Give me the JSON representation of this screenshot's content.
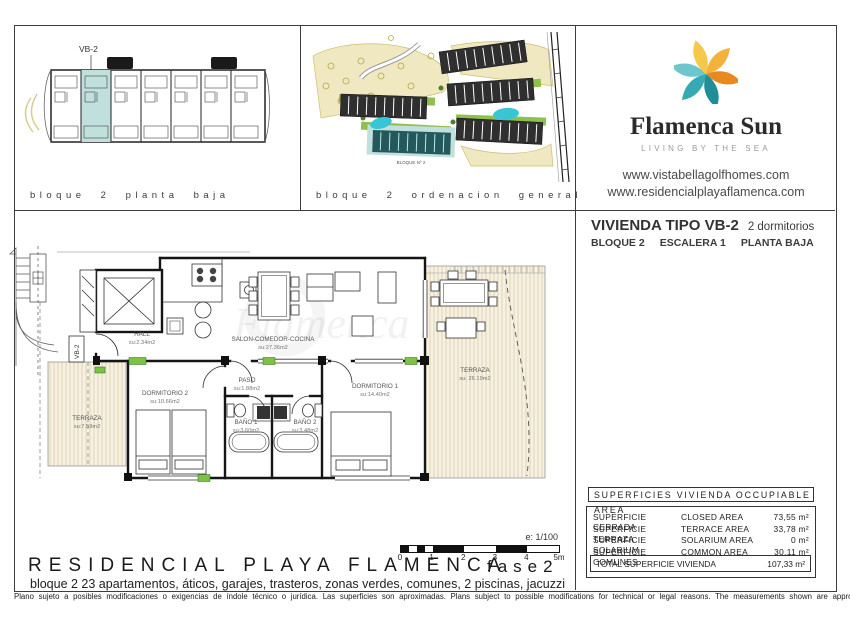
{
  "panels": {
    "block_plan": {
      "caption": "bloque 2 planta baja",
      "unit_label": "VB-2",
      "highlight_color": "#bfe0dd"
    },
    "site_plan": {
      "caption": "bloque 2 ordenacion general",
      "block_label": "BLOQUE Nº 2",
      "pool_color": "#38c6d6"
    }
  },
  "brand": {
    "name": "Flamenca Sun",
    "tagline": "LIVING BY THE SEA",
    "websites": [
      "www.vistabellagolfhomes.com",
      "www.residencialplayaflamenca.com"
    ],
    "logo_colors": [
      "#f3b23c",
      "#e8891f",
      "#1f8e96",
      "#35aab2",
      "#6cc6cb",
      "#f5c84c"
    ]
  },
  "unit_header": {
    "title": "VIVIENDA TIPO VB-2",
    "subtitle": "2 dormitorios",
    "line2": [
      "BLOQUE 2",
      "ESCALERA 1",
      "PLANTA BAJA"
    ]
  },
  "floor_plan": {
    "unit_tag": "VB-2",
    "watermark": "Flamenca Sun",
    "marker_color": "#7dc242",
    "terrace_fill": "#f6f1e2",
    "rooms": {
      "hall": {
        "name": "HALL",
        "area": "su:2.34m2"
      },
      "salon": {
        "name": "SALON-COMEDOR-COCINA",
        "area": "su:27.36m2"
      },
      "paso": {
        "name": "PASO",
        "area": "su:1.88m2"
      },
      "dormitorio1": {
        "name": "DORMITORIO 1",
        "area": "su:14.40m2"
      },
      "dormitorio2": {
        "name": "DORMITORIO 2",
        "area": "su:10.66m2"
      },
      "bano1": {
        "name": "BAÑO 1",
        "area": "su:3.60m2"
      },
      "bano2": {
        "name": "BAÑO 2",
        "area": "su:3.48m2"
      },
      "terraza_izq": {
        "name": "TERRAZA",
        "area": "su:7.59m2"
      },
      "terraza_der": {
        "name": "TERRAZA",
        "area": "su: 26.19m2"
      }
    },
    "scale": {
      "note": "e: 1/100",
      "ticks": [
        "0",
        "1",
        "2",
        "3",
        "4",
        "5m"
      ]
    }
  },
  "areas_table": {
    "header": "SUPERFICIES  VIVIENDA  OCCUPIABLE  AREA",
    "rows": [
      {
        "es": "SUPERFICIE CERRADA",
        "en": "CLOSED AREA",
        "value": "73,55 m²"
      },
      {
        "es": "SUPERFICIE TERRAZA",
        "en": "TERRACE AREA",
        "value": "33,78 m²"
      },
      {
        "es": "SUPERFICIE SOLARIUM",
        "en": "SOLARIUM AREA",
        "value": "0 m²"
      },
      {
        "es": "SUPERFICIE COMUNES",
        "en": "COMMON AREA",
        "value": "30,11 m²"
      }
    ],
    "total_label": "TOTAL SUPERFICIE VIVIENDA",
    "total_value": "107,33 m²"
  },
  "footer": {
    "project": "RESIDENCIAL PLAYA FLAMENCA",
    "phase": "fase2",
    "description": "bloque 2   23 apartamentos, áticos, garajes, trasteros, zonas verdes, comunes, 2 piscinas, jacuzzi",
    "disclaimer": "Plano sujeto a posibles modificaciones o exigencias de índole técnico o jurídica. Las superficies son aproximadas. Plans subject to possible modifications for technical or legal reasons. The measurements shown are approximate"
  }
}
